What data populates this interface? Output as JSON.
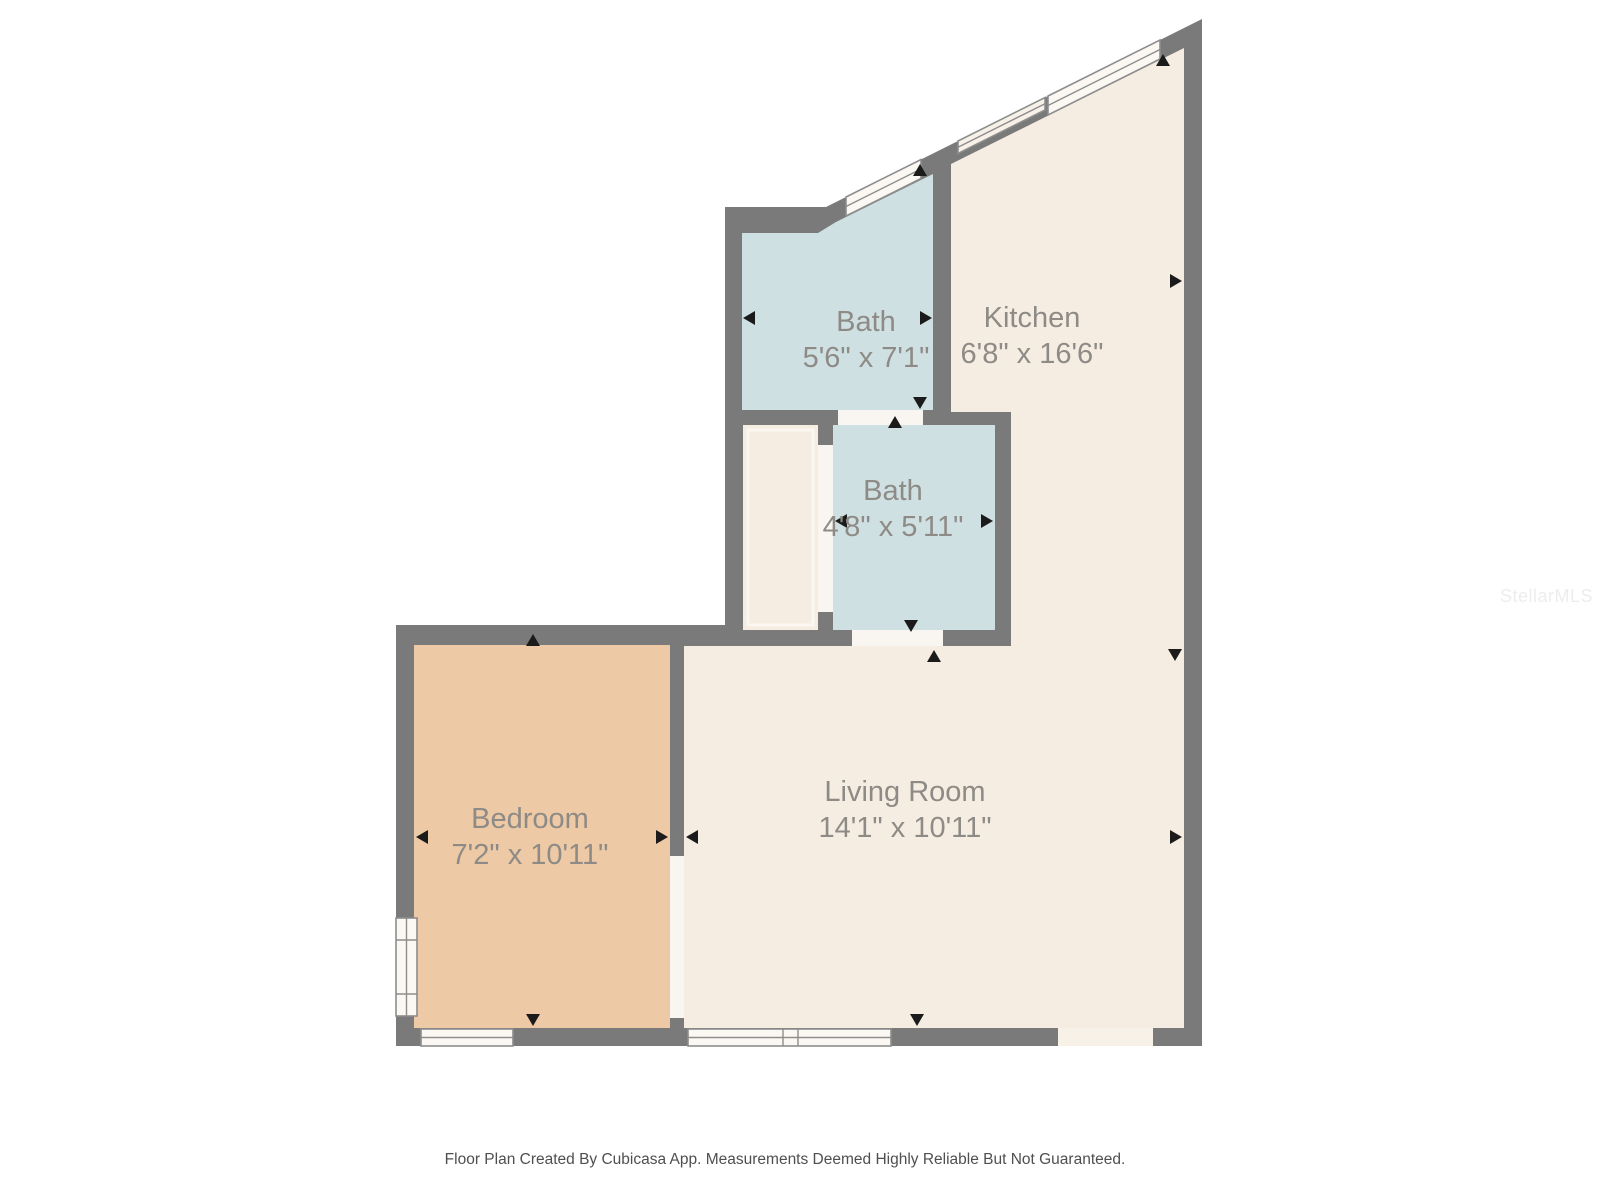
{
  "colors": {
    "wall": "#7a7a7a",
    "room_cream": "#f5ece2",
    "room_blue": "#cfe0e3",
    "room_tan": "#eec9a5",
    "window_fill": "#fbf8f3",
    "opening_fill": "#f7f1e8",
    "door_fill": "#f9f6f1",
    "arrow": "#1b1b1b",
    "label_text": "#8e8b86",
    "footer_text": "#4f4f4f",
    "watermark_text": "#ededed"
  },
  "rooms": [
    {
      "name": "Bath",
      "dimensions": "5'6\" x 7'1\""
    },
    {
      "name": "Kitchen",
      "dimensions": "6'8\" x 16'6\""
    },
    {
      "name": "Bath",
      "dimensions": "4'8\" x 5'11\""
    },
    {
      "name": "Bedroom",
      "dimensions": "7'2\" x 10'11\""
    },
    {
      "name": "Living Room",
      "dimensions": "14'1\" x 10'11\""
    }
  ],
  "footer": {
    "text": "Floor Plan Created By Cubicasa App. Measurements Deemed Highly Reliable But Not Guaranteed."
  },
  "watermark": {
    "text": "StellarMLS"
  }
}
